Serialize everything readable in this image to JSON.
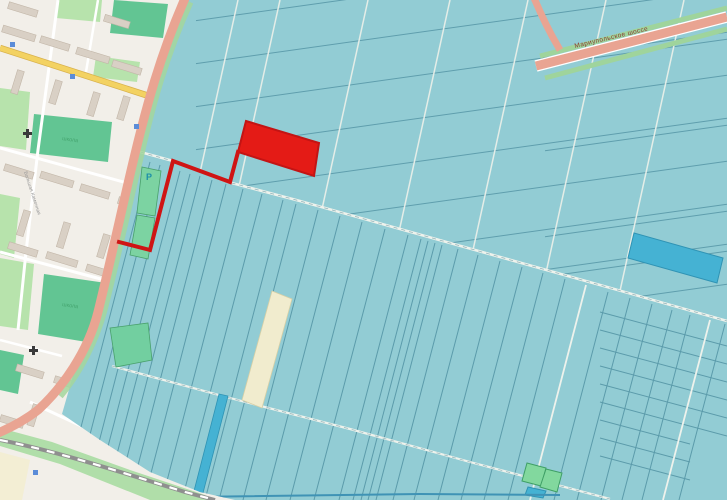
{
  "map": {
    "highway_label": "Мариупольское шоссе",
    "parking_label": "Р",
    "street_label": "Большая Каменная",
    "school_label": "школа",
    "colors": {
      "field": "#92ccd4",
      "parcel_line": "#4e8fa0",
      "boundary_white": "#eef2ec",
      "selection_red": "#e41b16",
      "selection_outline": "#cf1414",
      "dark_parcel": "#45b2d3",
      "cream_parcel": "#f1ecce",
      "highway": "#e9a492",
      "road_yellow": "#f3d262",
      "city_bg": "#f2efe9",
      "building": "#d9d0c5",
      "green_dark": "#62c593",
      "green_light": "#b7e3ac",
      "railway": "#8f8f8f"
    }
  }
}
